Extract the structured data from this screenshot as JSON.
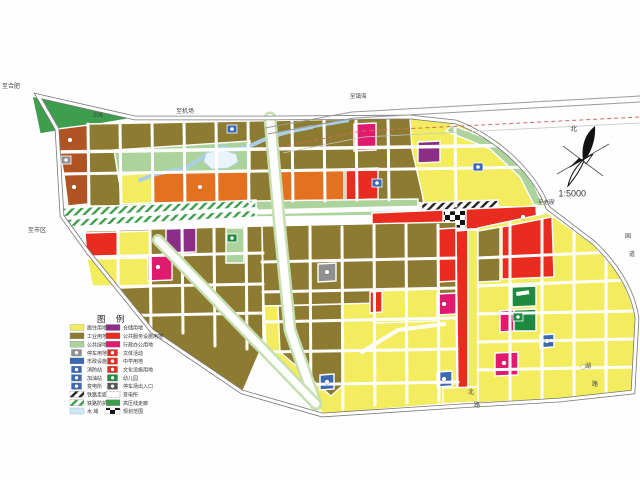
{
  "compass": {
    "north": "北",
    "scale": "1:5000"
  },
  "legend": {
    "title": "图 例",
    "left": [
      {
        "label": "居住用地",
        "swatch": "yellow"
      },
      {
        "label": "工业用地",
        "swatch": "olive"
      },
      {
        "label": "公共绿地",
        "swatch": "greenL"
      },
      {
        "label": "停车用地",
        "swatch": "gray-icon"
      },
      {
        "label": "市政设施用地",
        "swatch": "blue"
      },
      {
        "label": "消防站",
        "swatch": "blue-icon"
      },
      {
        "label": "加油站",
        "swatch": "blue-icon"
      },
      {
        "label": "变电所",
        "swatch": "blue-icon"
      },
      {
        "label": "铁路走廊",
        "swatch": "hatchB"
      },
      {
        "label": "铁路防护带",
        "swatch": "hatchG"
      },
      {
        "label": "水  域",
        "swatch": "water"
      }
    ],
    "right": [
      {
        "label": "仓储用地",
        "swatch": "purple"
      },
      {
        "label": "公共服务设施用地",
        "swatch": "red"
      },
      {
        "label": "行政办公用地",
        "swatch": "crimson"
      },
      {
        "label": "文体活动",
        "swatch": "red-icon"
      },
      {
        "label": "中学用地",
        "swatch": "red-icon"
      },
      {
        "label": "文化设施用地",
        "swatch": "red-icon"
      },
      {
        "label": "幼儿园",
        "swatch": "green-icon"
      },
      {
        "label": "停车场出入口",
        "swatch": "dark-icon"
      },
      {
        "label": "变电所",
        "swatch": "dashed"
      },
      {
        "label": "高压线走廊",
        "swatch": "green"
      },
      {
        "label": "规划范围",
        "swatch": "checker"
      }
    ]
  },
  "map": {
    "palette": {
      "yellow": "#f3ec5e",
      "olive": "#8d7b31",
      "greenL": "#abd39b",
      "green": "#3f9e4e",
      "greenD": "#1f8a3f",
      "rust": "#b05423",
      "orange": "#e4711f",
      "red": "#e82c20",
      "crimson": "#e01a6e",
      "purple": "#8b2e87",
      "blue": "#3b69b3",
      "gray": "#909090",
      "water": "#cde7f4"
    },
    "labels": [
      {
        "t": "206",
        "x": 93,
        "y": 117,
        "s": 6
      },
      {
        "t": "至机场",
        "x": 176,
        "y": 113,
        "s": 6
      },
      {
        "t": "至镇海",
        "x": 350,
        "y": 98,
        "s": 5.5
      },
      {
        "t": "至老碶",
        "x": 538,
        "y": 204,
        "s": 5.5
      },
      {
        "t": "至合肥",
        "x": 2,
        "y": 88,
        "s": 6
      },
      {
        "t": "至市区",
        "x": 28,
        "y": 232,
        "s": 6
      },
      {
        "t": "国",
        "x": 625,
        "y": 238,
        "s": 6
      },
      {
        "t": "道",
        "x": 629,
        "y": 256,
        "s": 6
      },
      {
        "t": "湖",
        "x": 585,
        "y": 368,
        "s": 6
      },
      {
        "t": "路",
        "x": 592,
        "y": 386,
        "s": 6
      },
      {
        "t": "北",
        "x": 468,
        "y": 394,
        "s": 6
      },
      {
        "t": "路",
        "x": 474,
        "y": 407,
        "s": 6
      }
    ],
    "boundary": "M38,96 L135,118 L265,118 L410,117 L456,122 C498,138 534,172 548,208 L594,243 C616,264 633,290 637,318 L633,392 L560,400 L460,406 L322,415 L242,392 L152,331 L88,252 L62,216 L57,129 Z",
    "zones": [
      {
        "cat": "green",
        "pts": "32,96 140,117 40,134"
      },
      {
        "cat": "olive",
        "pts": "88,124 410,118 424,205 86,206"
      },
      {
        "cat": "yellow",
        "pts": "410,118 456,123 500,142 532,175 546,207 425,206 412,150"
      },
      {
        "cat": "greenL",
        "pts": "452,125 498,143 530,176 543,205 534,205 520,177 490,149 446,131"
      },
      {
        "cat": "rust",
        "pts": "57,129 88,125 88,151 60,153"
      },
      {
        "cat": "rust",
        "pts": "60,153 88,151 88,173 64,175"
      },
      {
        "cat": "rust",
        "pts": "64,175 88,173 88,204 68,206"
      },
      {
        "cat": "greenL",
        "pts": "114,150 250,141 250,173 119,181"
      },
      {
        "cat": "yellow",
        "pts": "119,175 152,173 152,203 121,204"
      },
      {
        "cat": "orange",
        "pts": "152,173 248,170 248,201 153,203"
      },
      {
        "cat": "orange",
        "pts": "278,170 344,169 344,200 278,201"
      },
      {
        "cat": "red",
        "pts": "346,169 378,168 378,199 346,200"
      },
      {
        "cat": "crimson",
        "pts": "354,124 376,123 376,150 354,151"
      },
      {
        "cat": "purple",
        "pts": "418,142 440,141 440,162 418,163"
      },
      {
        "cat": "greenL",
        "pts": "256,201 418,199 418,215 256,217"
      },
      {
        "cat": "hatchG",
        "pts": "62,208 256,200 256,217 66,227"
      },
      {
        "cat": "hatchB",
        "pts": "418,203 498,200 498,213 418,216"
      },
      {
        "cat": "red",
        "pts": "372,213 536,206 537,227 372,232"
      },
      {
        "cat": "checker",
        "pts": "443,211 466,210 466,228 443,229"
      },
      {
        "cat": "olive",
        "pts": "85,231 262,226 263,344 243,391 153,331 88,253"
      },
      {
        "cat": "red",
        "pts": "85,233 118,232 118,257 87,258"
      },
      {
        "cat": "yellow",
        "pts": "118,232 150,231 150,257 118,257"
      },
      {
        "cat": "yellow",
        "pts": "87,259 150,258 150,287 93,289"
      },
      {
        "cat": "purple",
        "pts": "166,229 196,228 196,252 166,253"
      },
      {
        "cat": "crimson",
        "pts": "148,255 172,254 172,280 148,281"
      },
      {
        "cat": "greenL",
        "pts": "226,228 244,228 244,263 226,263"
      },
      {
        "cat": "olive",
        "pts": "262,226 456,222 456,303 264,306"
      },
      {
        "cat": "yellow",
        "pts": "264,306 456,301 457,388 443,404 323,414 266,346"
      },
      {
        "cat": "olive",
        "pts": "278,306 342,304 342,386 331,396 280,352"
      },
      {
        "cat": "red",
        "pts": "438,229 456,228 456,281 438,282"
      },
      {
        "cat": "gray",
        "pts": "318,264 336,263 336,281 318,282"
      },
      {
        "cat": "yellow",
        "pts": "374,291 438,289 438,321 374,323"
      },
      {
        "cat": "red",
        "pts": "370,292 382,291 382,312 370,313"
      },
      {
        "cat": "crimson",
        "pts": "437,294 456,293 456,314 437,315"
      },
      {
        "cat": "red",
        "pts": "456,231 468,230 468,387 458,389"
      },
      {
        "cat": "yellow",
        "pts": "468,230 478,230 478,387 468,387"
      },
      {
        "cat": "yellow",
        "pts": "478,228 548,213 593,244 622,277 637,318 633,391 560,399 478,403"
      },
      {
        "cat": "yellow",
        "pts": "443,388 478,387 478,402 443,404"
      },
      {
        "cat": "olive",
        "pts": "478,231 500,227 500,281 478,282"
      },
      {
        "cat": "red",
        "pts": "502,227 552,217 554,277 502,279"
      },
      {
        "cat": "greenD",
        "pts": "512,287 536,286 536,306 512,307"
      },
      {
        "cat": "crimson",
        "pts": "500,311 514,310 514,331 500,332"
      },
      {
        "cat": "greenD",
        "pts": "514,310 536,309 536,331 514,331"
      },
      {
        "cat": "blue",
        "pts": "540,335 554,334 554,347 540,348"
      },
      {
        "cat": "crimson",
        "pts": "495,353 518,352 518,375 495,376"
      },
      {
        "cat": "blue",
        "pts": "437,372 452,371 452,386 437,387"
      },
      {
        "cat": "blue",
        "pts": "320,375 334,374 334,389 320,390"
      }
    ],
    "roads": [
      {
        "p": "88,124 89,205"
      },
      {
        "p": "120,123 121,204"
      },
      {
        "p": "152,122 153,203"
      },
      {
        "p": "184,121 185,203"
      },
      {
        "p": "216,120 217,202"
      },
      {
        "p": "248,120 249,202"
      },
      {
        "p": "292,119 293,201"
      },
      {
        "p": "324,118 325,201"
      },
      {
        "p": "356,118 357,200"
      },
      {
        "p": "388,117 389,200"
      },
      {
        "p": "455,123 456,206"
      },
      {
        "p": "57,152 544,145",
        "w": 3.5
      },
      {
        "p": "60,174 540,167"
      },
      {
        "p": "118,231 118,288"
      },
      {
        "p": "150,231 151,331"
      },
      {
        "p": "182,228 183,333"
      },
      {
        "p": "214,228 215,346"
      },
      {
        "p": "246,227 247,349"
      },
      {
        "p": "86,257 263,253"
      },
      {
        "p": "91,287 263,284"
      },
      {
        "p": "109,316 264,313"
      },
      {
        "p": "310,227 311,410"
      },
      {
        "p": "342,227 343,409"
      },
      {
        "p": "374,225 375,405"
      },
      {
        "p": "406,225 407,403"
      },
      {
        "p": "438,225 439,401"
      },
      {
        "p": "262,262 456,258"
      },
      {
        "p": "263,292 456,288"
      },
      {
        "p": "264,322 456,318"
      },
      {
        "p": "266,352 457,349"
      },
      {
        "p": "270,385 458,382"
      },
      {
        "p": "510,223 510,402"
      },
      {
        "p": "542,219 542,400"
      },
      {
        "p": "574,228 574,400"
      },
      {
        "p": "606,250 606,397"
      },
      {
        "p": "478,258 614,252"
      },
      {
        "p": "478,286 630,280"
      },
      {
        "p": "478,314 637,311"
      },
      {
        "p": "478,342 636,339"
      },
      {
        "p": "478,370 634,367"
      },
      {
        "p": "64,218 256,209",
        "w": 4
      },
      {
        "p": "256,212 420,208",
        "w": 5
      },
      {
        "p": "270,118 280,230 290,330 316,404",
        "w": 8,
        "c": "#c6dfb0"
      },
      {
        "p": "158,240 316,404",
        "w": 7,
        "c": "#c6dfb0"
      },
      {
        "p": "362,352 398,330 444,324",
        "w": 4
      },
      {
        "p": "36,96 8,88",
        "w": 3.5
      },
      {
        "p": "62,216 28,233",
        "w": 3.5
      },
      {
        "p": "322,414 317,440",
        "w": 3.5
      },
      {
        "p": "460,406 463,430",
        "w": 3
      }
    ],
    "rails": [
      {
        "p": "265,128 352,112 640,96",
        "w": 1,
        "col": "#9a9a9a"
      },
      {
        "p": "268,134 354,118 640,102",
        "w": 1,
        "col": "#9a9a9a"
      },
      {
        "p": "280,147 362,131 640,117",
        "w": 1,
        "col": "#d4685a",
        "dash": "4,3"
      },
      {
        "p": "283,153 364,137 640,123",
        "w": 0.8,
        "col": "#c8c8c8"
      }
    ],
    "river": [
      {
        "p": "312,127 292,131 270,137 252,145 236,150 222,147 210,152 196,162 184,169 170,171 156,174 140,180",
        "w": 4
      },
      {
        "p": "312,127 330,124 348,121",
        "w": 2.5
      }
    ],
    "pond": "206,153 222,150 236,154 238,162 228,168 212,169 204,162",
    "iconBoxes": [
      {
        "c": "blue",
        "x": 227,
        "y": 125
      },
      {
        "c": "blue",
        "x": 372,
        "y": 179
      },
      {
        "c": "blue",
        "x": 473,
        "y": 163
      },
      {
        "c": "gray",
        "x": 61,
        "y": 156
      },
      {
        "c": "greenD",
        "x": 227,
        "y": 234
      },
      {
        "c": "greenD",
        "x": 513,
        "y": 313
      }
    ],
    "bar": {
      "x": 516,
      "y": 292,
      "w": 13,
      "h": 4
    },
    "dots": [
      {
        "x": 158,
        "y": 267
      },
      {
        "x": 444,
        "y": 304
      },
      {
        "x": 504,
        "y": 363
      },
      {
        "x": 523,
        "y": 217
      },
      {
        "x": 70,
        "y": 140
      },
      {
        "x": 74,
        "y": 187
      },
      {
        "x": 327,
        "y": 272
      },
      {
        "x": 583,
        "y": 367
      },
      {
        "x": 547,
        "y": 341
      },
      {
        "x": 444,
        "y": 379
      },
      {
        "x": 327,
        "y": 382
      },
      {
        "x": 200,
        "y": 187
      }
    ]
  }
}
